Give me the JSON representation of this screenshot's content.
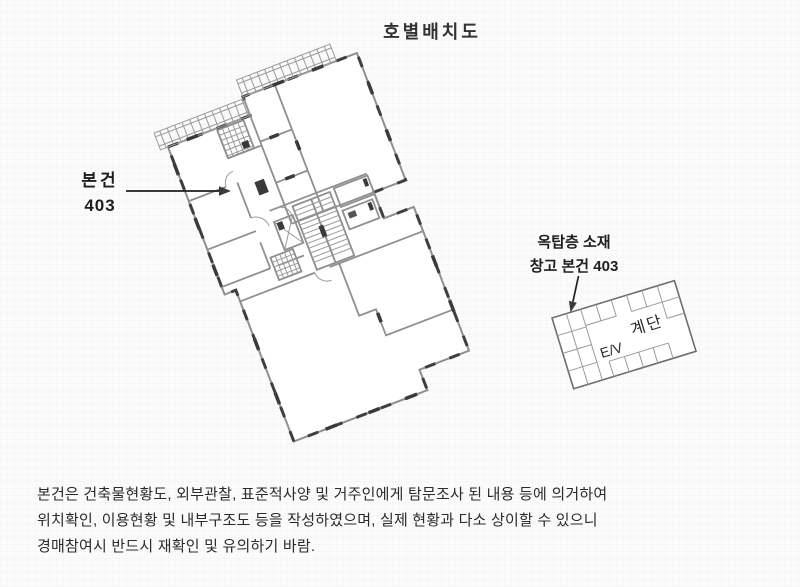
{
  "page": {
    "background": "#fbfbfb"
  },
  "title": "호별배치도",
  "floor_plan": {
    "unit_label_line1": "본건",
    "unit_label_line2": "403"
  },
  "storage_diagram": {
    "label_line1": "옥탑층 소재",
    "label_line2": "창고 본건 403",
    "elevator_label": "E/V",
    "stairs_label": "계단"
  },
  "disclaimer": {
    "line1": "본건은 건축물현황도, 외부관찰, 표준적사양 및 거주인에게 탐문조사 된 내용 등에 의거하여",
    "line2": "위치확인, 이용현황 및 내부구조도 등을 작성하였으며, 실제 현황과 다소 상이할 수 있으니",
    "line3": "경매참여시 반드시 재확인 및 유의하기 바람."
  },
  "colors": {
    "line_gray": "#8f8f8f",
    "wall_dark": "#3a3a3a",
    "text_dark": "#1f1f1f"
  }
}
